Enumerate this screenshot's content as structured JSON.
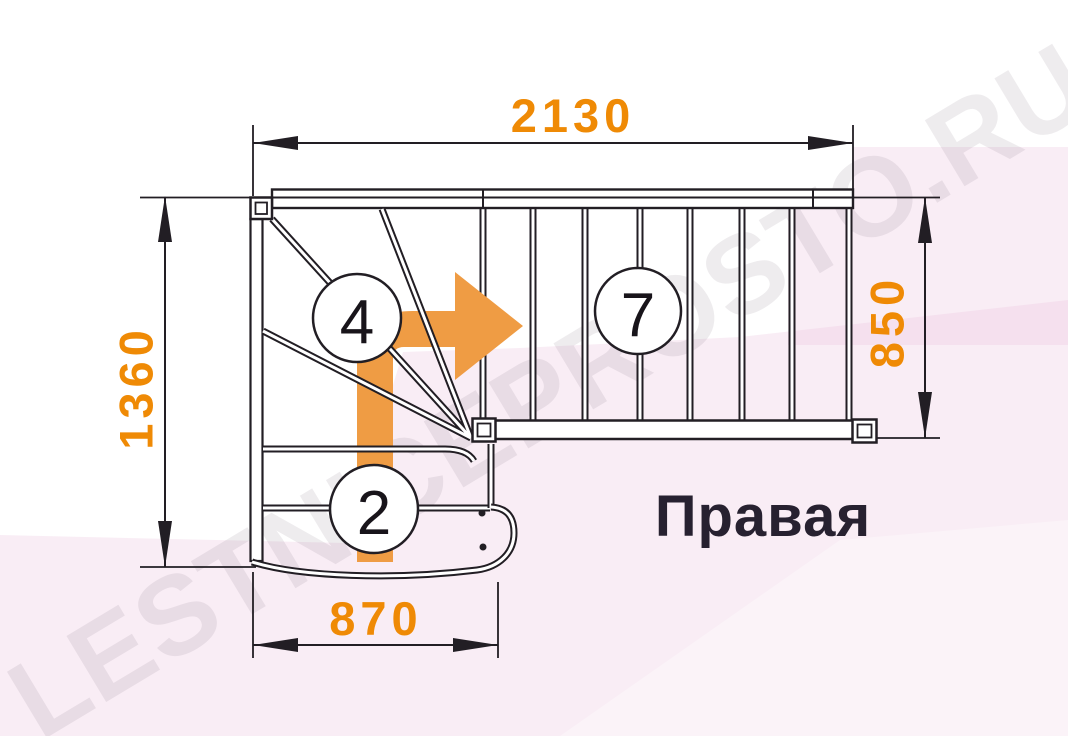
{
  "drawing": {
    "orientation_label": "Правая",
    "watermark": "LESTNICEPROSTO.RU",
    "dimensions": {
      "total_length_top": "2130",
      "total_depth_left": "1360",
      "flight_width_right": "850",
      "bottom_flight_width": "870"
    },
    "step_markers": {
      "winder_step": "4",
      "straight_flight_step": "7",
      "bottom_flight_step": "2"
    },
    "icons": {
      "direction_arrow": "up-then-right-arrow"
    },
    "colors": {
      "dimension_text": "#EF8A05",
      "direction_arrow": "#EF9C44",
      "linework": "#221E24",
      "background_tint": "#F5E2EE",
      "watermark_gray": "#ECE9EC"
    }
  }
}
